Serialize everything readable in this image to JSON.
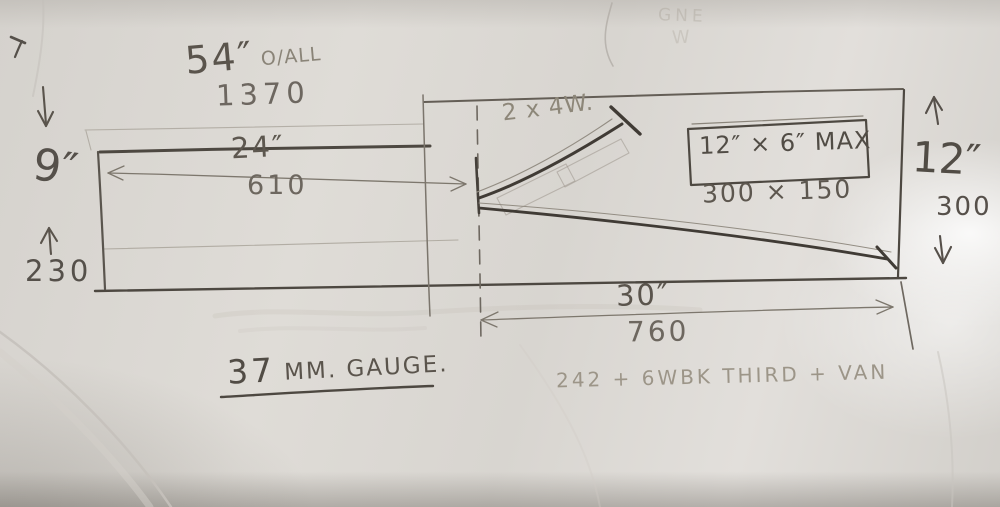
{
  "sketch": {
    "overall": {
      "length_in": "54″",
      "suffix": "O/ALL",
      "length_mm": "1370"
    },
    "left_board": {
      "length_in": "24″",
      "length_mm": "610",
      "depth_in": "9″",
      "depth_mm": "230"
    },
    "siding_note": "2 x 4W.",
    "max_box": {
      "size_in": "12″ × 6″ MAX",
      "size_mm": "300 × 150"
    },
    "main_board": {
      "depth_in": "12″",
      "depth_mm": "300",
      "length_in": "30″",
      "length_mm": "760"
    },
    "gauge": {
      "number": "37",
      "text": "MM. GAUGE."
    },
    "stock_note": "242 + 6WBK THIRD + VAN",
    "ghost": {
      "line1": "GNE",
      "line2": "W"
    }
  }
}
